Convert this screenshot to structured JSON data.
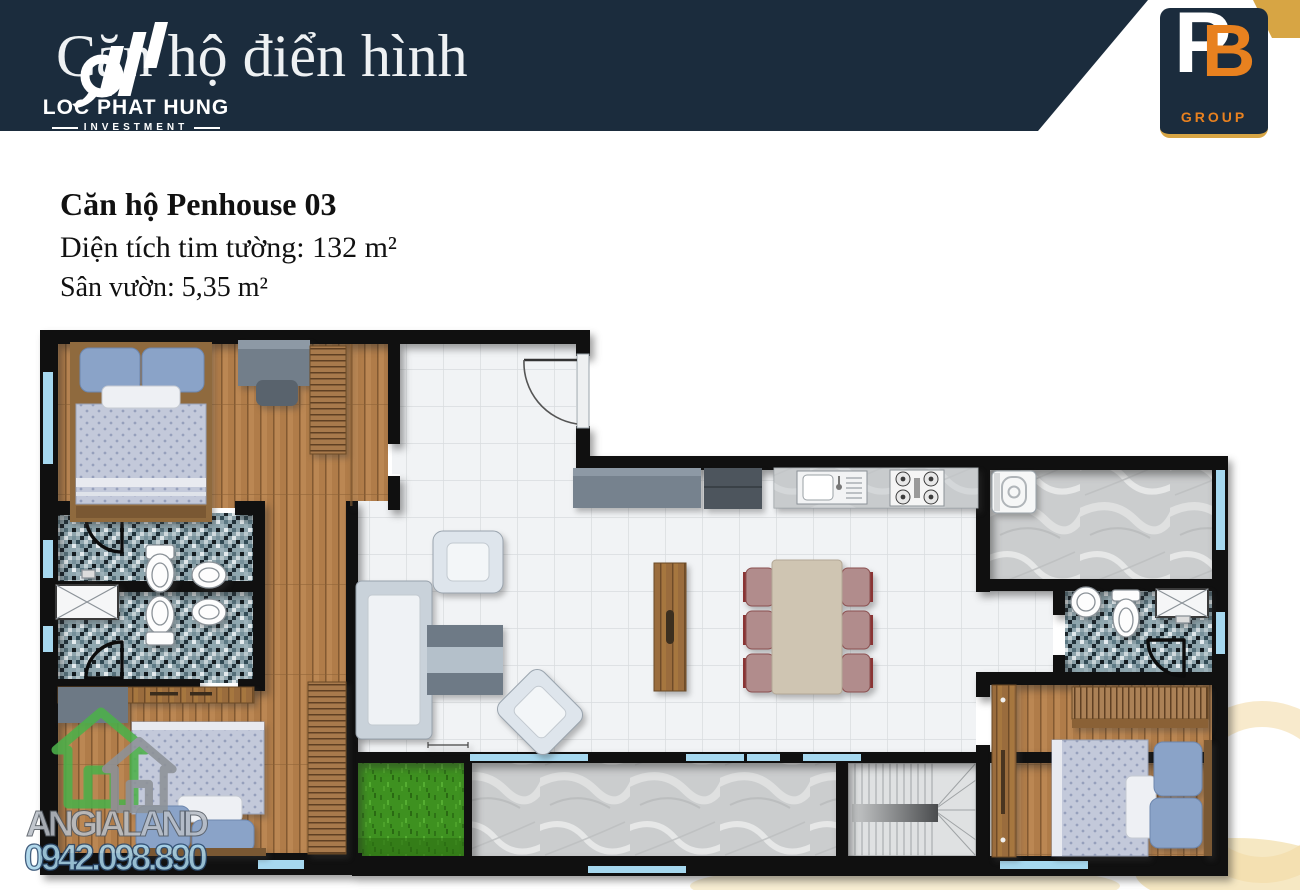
{
  "header": {
    "title": "Căn hộ điển hình",
    "brand": {
      "name": "LOC PHAT HUNG",
      "tagline": "INVESTMENT"
    },
    "logo": {
      "monogram_p": "P",
      "monogram_b": "B",
      "label": "GROUP"
    }
  },
  "unit_info": {
    "name": "Căn hộ Penhouse 03",
    "wall_area": "Diện tích tim tường: 132 m²",
    "garden_area": "Sân vườn: 5,35 m²"
  },
  "watermarks": {
    "agency": "ANGIALAND",
    "phone": "0942.098.890"
  },
  "colors": {
    "navy": "#1b2c3d",
    "orange": "#e8811f",
    "gold": "#d7a544",
    "wall": "#101010",
    "window": "#a6d8ef",
    "tile": "#f0f2f4",
    "wood": "#b07c49",
    "marble": "#cbcdce",
    "grass": "#3e9120",
    "mosaic": "#7d98a1",
    "duvet": "#c3c9da",
    "pillow": "#8aa3c8",
    "sofa": "#dee5ec",
    "table": "#cfc5b2",
    "chair": "#b18c8c",
    "wm_green": "#4db04a",
    "wm_gray": "#b9bfc7",
    "wm_blue": "#a8d4ea"
  }
}
